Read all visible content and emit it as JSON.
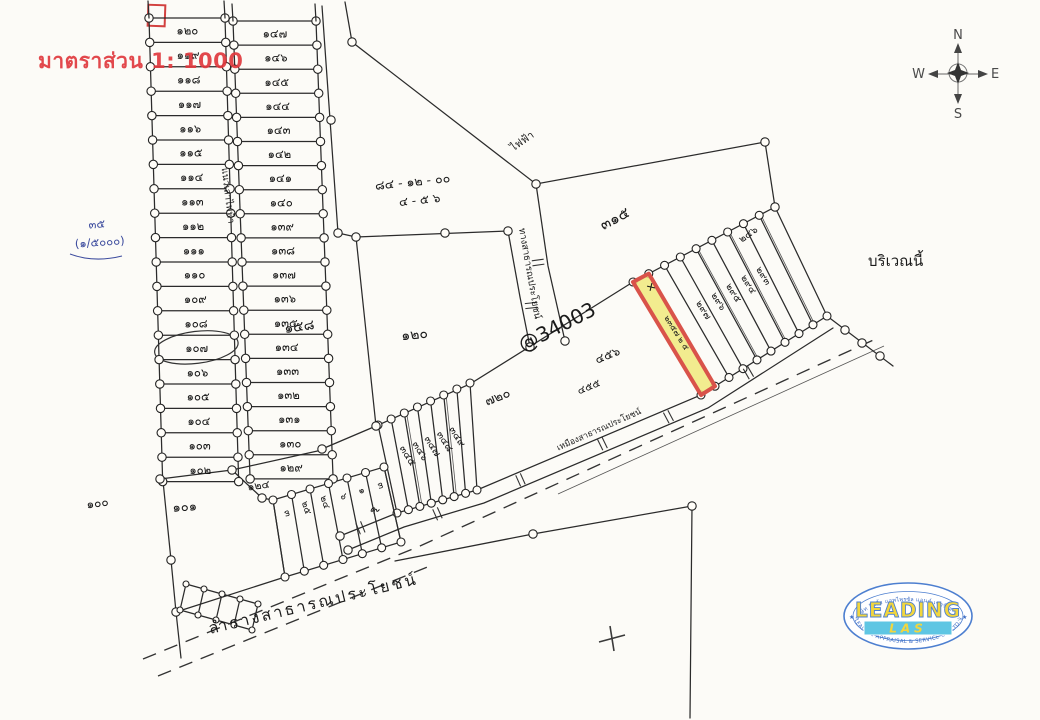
{
  "scale_label": "มาตราส่วน 1: 1000",
  "compass": {
    "north": "N",
    "south": "S",
    "east": "E",
    "west": "W"
  },
  "margin_note": {
    "line1": "๓๕",
    "line2": "(๑/๕๐๐๐)"
  },
  "area_note": {
    "line1": "๘๔ - ๑๒ - ๐๐",
    "line2": "๔ - ๕ ๖"
  },
  "power_label": "ไฟฟ้า",
  "lane_label": "แนวเสาไฟฟ้า",
  "road_label": "ทางสาธารณประโยชน์",
  "ditch_label": "เหมืองสาธารณประโยชน์",
  "canal_label": "ลำรางสาธารณประโยชน์",
  "region_note": "บริเวณนี้",
  "ref_code": "@34003",
  "highlight": {
    "note": "๒๓๕๗ ๒ ๕",
    "mark": "✕",
    "fill": "#f0e97c",
    "stroke": "#d9534a"
  },
  "parcels": {
    "column_a": [
      "๑๒๐",
      "๑๑๙",
      "๑๑๘",
      "๑๑๗",
      "๑๑๖",
      "๑๑๕",
      "๑๑๔",
      "๑๑๓",
      "๑๑๒",
      "๑๑๑",
      "๑๑๐",
      "๑๐๙",
      "๑๐๘",
      "๑๐๗",
      "๑๐๖",
      "๑๐๕",
      "๑๐๔",
      "๑๐๓",
      "๑๐๒"
    ],
    "column_a_circled": "๑๐๗",
    "column_b": [
      "๑๔๗",
      "๑๔๖",
      "๑๔๕",
      "๑๔๔",
      "๑๔๓",
      "๑๔๒",
      "๑๔๑",
      "๑๔๐",
      "๑๓๙",
      "๑๓๘",
      "๑๓๗",
      "๑๓๖",
      "๑๓๕",
      "๑๓๔",
      "๑๓๓",
      "๑๓๒",
      "๑๓๑",
      "๑๓๐",
      "๑๒๙"
    ],
    "below_a": "๑๐๑",
    "below_b": "๑๒๔",
    "far_left": "๑๐๐",
    "large_left": "๑๕๘",
    "large_mid": "๑๒๐",
    "large_top": "๓๑๕",
    "large_center": "๗๒๐",
    "near_highlight": [
      "๔๕๖",
      "๔๕๕"
    ],
    "right_note": "๒๔๖"
  },
  "fan_center_numbers": [
    "๓๔๕",
    "๓๔๖",
    "๓๔๗",
    "๓๔๘",
    "๓๔๙"
  ],
  "fan_left_numbers": [
    "๓",
    "๒๕",
    "๒๔",
    "๖",
    "๑",
    "๓"
  ],
  "fan_left_outside": "๙",
  "fan_right_numbers": [
    "๒๙๗",
    "๒๙๖",
    "๒๙๕",
    "๒๙๔",
    "๒๙๓"
  ],
  "logo": {
    "name": "LEADING",
    "sub": "LAS",
    "arc_top": "บริษัท ลีดดิ้ง แอพไพรซัล แอนด์ เซอร์วิส จำกัด",
    "arc_bottom": "LEADING APPRAISAL & SERVICE CO.,LTD.",
    "border": "#4d7fd0",
    "text": "#f2d63d",
    "bar": "#5fc6e3"
  }
}
